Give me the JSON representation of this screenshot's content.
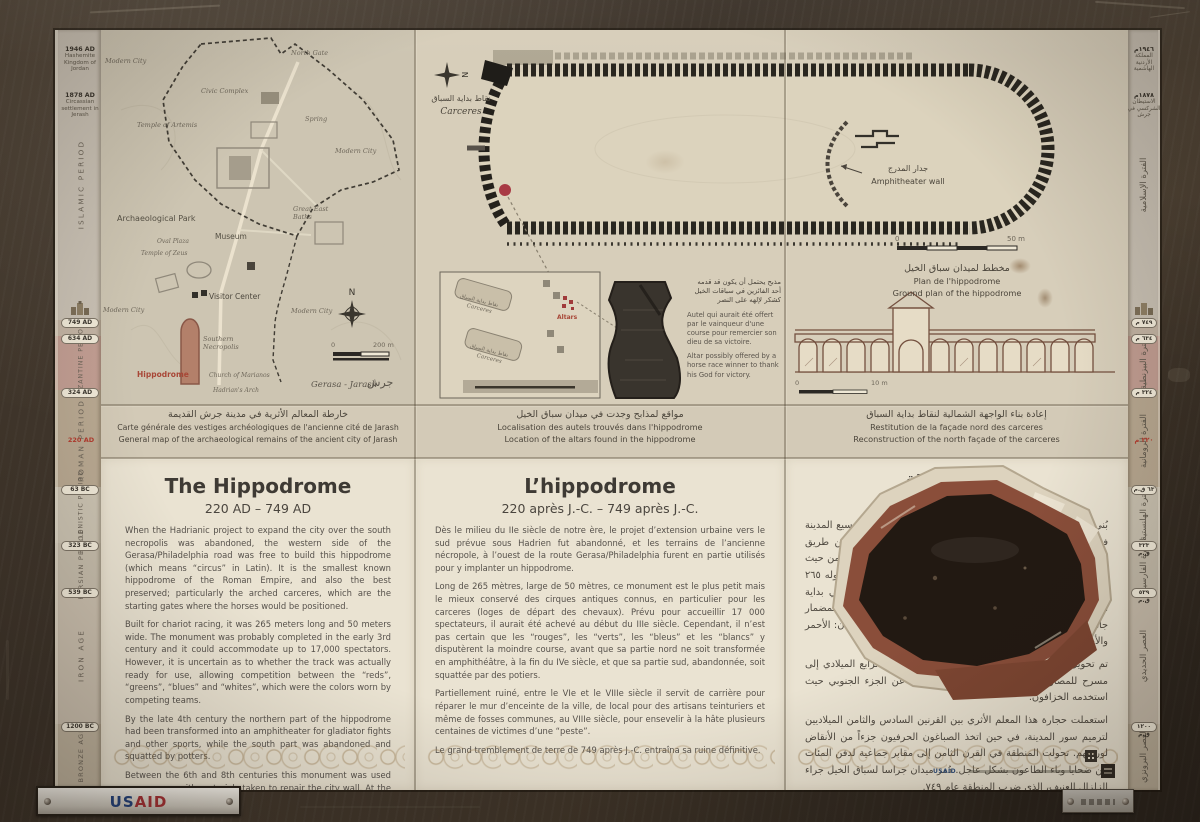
{
  "sign": {
    "timeline_left": {
      "events": [
        {
          "date": "1946 AD",
          "label": "Hashemite Kingdom of Jordan"
        },
        {
          "date": "1878 AD",
          "label": "Circassian settlement in Jerash"
        }
      ],
      "periods": [
        "ISLAMIC PERIOD",
        "BYZANTINE PERIOD",
        "ROMAN PERIOD",
        "HELLENISTIC PERIOD",
        "PERSIAN PERIOD",
        "IRON AGE",
        "BRONZE AGE"
      ],
      "markers": [
        "749 AD",
        "634 AD",
        "324 AD",
        "63 BC",
        "323 BC",
        "539 BC",
        "1200 BC"
      ],
      "highlight_date": "220 AD"
    },
    "timeline_right": {
      "events": [
        {
          "date": "١٩٤٦م",
          "label": "المملكة الأردنية الهاشمية"
        },
        {
          "date": "١٨٧٨م",
          "label": "الاستيطان الشركسي في جرش"
        }
      ],
      "periods": [
        "الفترة الإسلامية",
        "الفترة البيزنطية",
        "الفترة الرومانية",
        "الفترة الهلنستية",
        "الفترة الفارسية",
        "العصر الحديدي",
        "العصر البرونزي"
      ],
      "markers": [
        "٧٤٩ م",
        "٦٣٤ م",
        "٣٢٤ م",
        "٦٣ ق.م",
        "٣٢٣ ق.م",
        "٥٣٩ ق.م",
        "١٢٠٠ ق.م"
      ],
      "highlight_date": "٢٢٠ م"
    },
    "map": {
      "labels": {
        "modern_city_nw": "Modern City",
        "north_gate": "North Gate",
        "civic_complex": "Civic Complex",
        "spring": "Spring",
        "temple_of_artemis": "Temple of Artemis",
        "modern_city_e": "Modern City",
        "archaeological_park": "Archaeological Park",
        "great_east_baths": "Great East Baths",
        "museum": "Museum",
        "oval_plaza": "Oval Plaza",
        "temple_of_zeus": "Temple of Zeus",
        "visitor_center": "Visitor Center",
        "modern_city_sw": "Modern City",
        "modern_city_se": "Modern City",
        "southern_necropolis": "Southern Necropolis",
        "hippodrome": "Hippodrome",
        "church_of_marianos": "Church of Marianos",
        "hadrians_arch": "Hadrian's Arch"
      },
      "compass": "N",
      "scale_zero": "0",
      "scale_max": "200 m",
      "place_latin": "Gerasa - Jarash",
      "place_arabic": "جرش",
      "caption": {
        "ar": "خارطة المعالم الأثرية في مدينة جرش القديمة",
        "fr": "Carte générale des vestiges archéologiques de l'ancienne cité de Jarash",
        "en": "General map of the archaeological remains of the ancient city of Jarash"
      }
    },
    "plan": {
      "carceres_ar": "نقاط بداية السباق",
      "carceres_latin": "Carceres",
      "wall_ar": "جدار المدرج",
      "wall_en": "Amphitheater wall",
      "compass": "N",
      "scale_zero": "0",
      "scale_max": "50 m",
      "caption": {
        "ar": "مخطط لميدان سباق الخيل",
        "fr": "Plan de l'hippodrome",
        "en": "Ground plan of the hippodrome"
      }
    },
    "altars": {
      "gate_label_ar": "نقاط بداية السباق",
      "gate_label_latin": "Carceres",
      "altars_label": "Altars",
      "note_ar": "مذبح يحتمل أن يكون قد قدمه أحد الفائزين في سباقات الخيل كشكر لإلهه على النصر",
      "note_fr": "Autel qui aurait été offert par le vainqueur d'une course pour remercier son dieu de sa victoire.",
      "note_en": "Altar possibly offered by a horse race winner to thank his God for victory.",
      "caption": {
        "ar": "مواقع لمذابح وجدت في ميدان سباق الخيل",
        "fr": "Localisation des autels trouvés dans l'hippodrome",
        "en": "Location of the altars found in the hippodrome"
      }
    },
    "facade": {
      "scale_zero": "0",
      "scale_max": "10 m",
      "caption": {
        "ar": "إعادة بناء الواجهة الشمالية لنقاط بداية السباق",
        "fr": "Restitution de la façade nord des carceres",
        "en": "Reconstruction of the north façade of the carceres"
      }
    },
    "panels": {
      "english": {
        "title": "The Hippodrome",
        "dates": "220 AD – 749 AD",
        "paragraphs": [
          "When the Hadrianic project to expand the city over the south necropolis was abandoned, the western side of the Gerasa/Philadelphia road was free to build this hippodrome (which means “circus” in Latin). It is the smallest known hippodrome of the Roman Empire, and also the best preserved; particularly the arched carceres, which are the starting gates where the horses would be positioned.",
          "Built for chariot racing, it was 265 meters long and 50 meters wide. The monument was probably completed in the early 3rd century and it could accommodate up to 17,000 spectators. However, it is uncertain as to whether the track was actually ready for use, allowing competition between the “reds”, “greens”, “blues” and “whites”, which were the colors worn by competing teams.",
          "By the late 4th century the northern part of the hippodrome had been transformed into an amphitheater for gladiator fights and other sports, while the south part was abandoned and squatted by potters.",
          "Between the 6th and 8th centuries this monument was used as a quarry, with materials taken to repair the city wall. At the same time, artisan dyers reused part of the ruins as workshops. In the 8th century the area became the site of mass graves for the hurried burial of hundreds of victims of a plague. It was the great earthquake of 749 AD that led to the final ruin of the Gerasa hippodrome."
        ]
      },
      "french": {
        "title": "L’hippodrome",
        "dates": "220 après J.-C. – 749 après J.-C.",
        "paragraphs": [
          "Dès le milieu du IIe siècle de notre ère, le projet d’extension urbaine vers le sud prévue sous Hadrien fut abandonné, et les terrains de l’ancienne nécropole, à l’ouest de la route Gerasa/Philadelphia furent en partie utilisés pour y implanter un hippodrome.",
          "Long de 265 mètres, large de 50 mètres, ce monument est le plus petit mais le mieux conservé des cirques antiques connus, en particulier pour les carceres (loges de départ des chevaux). Prévu pour accueillir 17 000 spectateurs, il aurait été achevé au début du IIIe siècle. Cependant, il n’est pas certain que les “rouges”, les “verts”, les “bleus” et les “blancs” y disputèrent la moindre course, avant que sa partie nord ne soit transformée en amphithéâtre, à la fin du IVe siècle, et que sa partie sud, abandonnée, soit squattée par des potiers.",
          "Partiellement ruiné, entre le VIe et le VIIIe siècle il servit de carrière pour réparer le mur d’enceinte de la ville, de local pour des artisans teinturiers et même de fosses communes, au VIIIe siècle, pour ensevelir à la hâte plusieurs centaines de victimes d’une “peste”.",
          "Le grand tremblement de terre de 749 après J.-C. entraîna sa ruine définitive."
        ]
      },
      "arabic": {
        "title": "ميدان السباق",
        "dates": "٢٢٠ – ٧٤٩ ميلادي",
        "paragraphs": [
          "بُني ميدان جراسا لسباق الخيل عندما تم التخلي عن مشروع توسيع المدينة في المقبرة الجنوبية، إذ أصبح بناؤه ممكناً في الجهة الغربية من طريق جراسا/فيلادلفيا. يُعد هذا الميدان أصغر ميدان معروف ومن أفضلها من حيث الحفاظ عليه، وخاصة الفناء المقوس، حيث تصطف الخيول. يبلغ طوله ٢٦٥ متراً وعرضه ٥٠ متراً لسباق العربات، وقد اكتمل على الأرجح في بداية القرن الثالث وهو يتسع إلى ١٧٠٠٠ متفرج. ليس مؤكداً إن كان المضمار جاهزاً للاستخدام من قبل الفرق المتنافسة التي كانت ترتدي الألوان: الأحمر والأخضر والأزرق والأبيض.",
          "تم تحويل الجزء الشمالي من الميدان في أواخر القرن الرابع الميلادي إلى مسرح للمصارعة الرومانية، في حين تم التخلي عن الجزء الجنوبي حيث استخدمه الخزافون.",
          "استعملت حجارة هذا المعلم الأثري بين القرنين السادس والثامن الميلاديين لترميم سور المدينة، في حين اتخذ الصباغون الحرفيون جزءاً من الأنقاض لورشهم. تحولت المنطقة في القرن الثامن إلى مقابر جماعية لدفن المئات من ضحايا وباء الطاعون بشكل عاجل. دُمر ميدان جراسا لسباق الخيل جراء الزلزال العنيف، الذي ضرب المنطقة عام ٧٤٩."
        ]
      }
    },
    "plaques": {
      "usaid_us": "US",
      "usaid_aid": "AID",
      "usaid_small": "USAID"
    }
  }
}
